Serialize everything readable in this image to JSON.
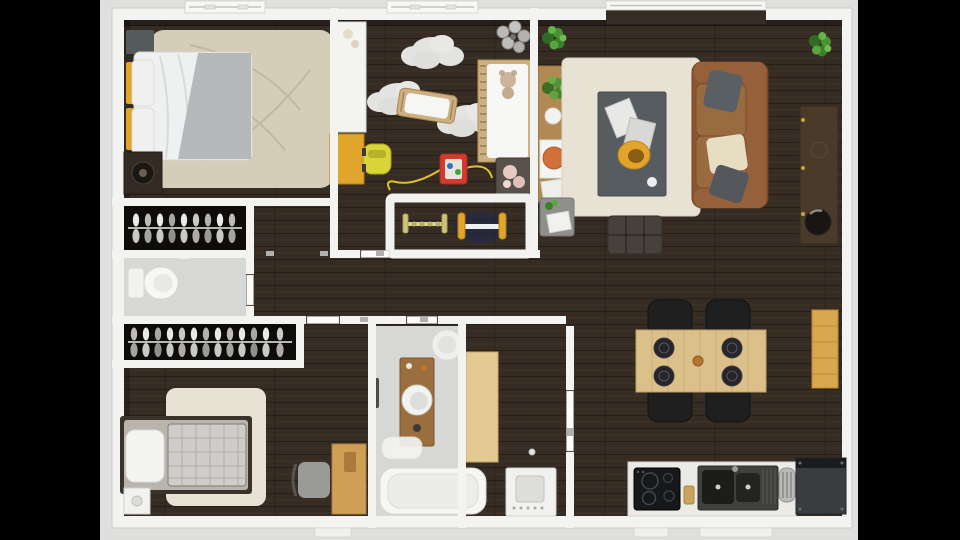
{
  "scene": {
    "title": "3D rendered top-down apartment floor plan, letterboxed on black",
    "type": "floor-plan-render"
  },
  "colors": {
    "letterbox": "#000000",
    "backdrop": "#dfdfdd",
    "wall": "#f3f3f1",
    "wall_edge": "#c9c9c7",
    "floor_dark": "#372c23",
    "floor_light": "#d7d7d5",
    "closet_dark": "#0d0c0b",
    "rug_beige": "#d6cdb9",
    "rug_cream": "#e7e2d4",
    "bed_white": "#eff0f0",
    "blanket_gray": "#b6b9bb",
    "plaid_gray": "#cfcdc9",
    "sofa_brown": "#8a5732",
    "sofa_cushion": "#9a6a40",
    "coffee_table_gray": "#575c60",
    "ottoman_dark": "#46413b",
    "wood_light": "#e5c992",
    "wood_medium": "#b08a52",
    "wood_dark": "#4a3a29",
    "dining_wood": "#dcc08a",
    "desk_wood": "#cf9f55",
    "crib_wood": "#cbb083",
    "vanity_wood": "#9a6f3d",
    "bench_wood": "#d9a84e",
    "accent_yellow": "#e0a52a",
    "toycar_yellow": "#d9d438",
    "plant_green": "#4a9334",
    "orange_plate": "#d2703b",
    "appliance_dark": "#3a3d3f",
    "cooktop_black": "#17181a",
    "sink_dark": "#3f413d",
    "chair_black": "#1f1f1f",
    "washer_white": "#f1f1ef"
  },
  "rooms": [
    {
      "name": "bedroom-1",
      "furniture": [
        "double-bed",
        "yellow-pillows",
        "gray-throw",
        "beige-rug",
        "nightstand",
        "speaker-cabinet",
        "window"
      ]
    },
    {
      "name": "closet-1",
      "furniture": [
        "clothes-rail-with-hangers"
      ]
    },
    {
      "name": "wc",
      "furniture": [
        "toilet"
      ]
    },
    {
      "name": "closet-2",
      "furniture": [
        "clothes-rail-with-hangers"
      ]
    },
    {
      "name": "bedroom-2",
      "furniture": [
        "single-bed",
        "plaid-blanket",
        "cream-rug",
        "white-nightstand",
        "wood-desk",
        "desk-chair"
      ]
    },
    {
      "name": "nursery",
      "furniture": [
        "white-wardrobe",
        "yellow-dresser",
        "toy-car",
        "cloud-rugs",
        "cradle",
        "crib-with-teddy",
        "pendant-lamp",
        "toy-blocks-with-string",
        "storage-basket-with-plush",
        "baby-gym-pen",
        "window"
      ]
    },
    {
      "name": "bathroom",
      "furniture": [
        "round-ceiling-lamp",
        "wood-vanity",
        "round-sink",
        "dark-towel",
        "bath-mat",
        "bathtub"
      ]
    },
    {
      "name": "laundry-hall",
      "furniture": [
        "wood-counter",
        "washing-machine",
        "door"
      ]
    },
    {
      "name": "living-room",
      "furniture": [
        "potted-plant-left",
        "potted-plant-right",
        "console-table-with-vase-and-plate",
        "cream-rug",
        "coffee-table-with-magazines-and-bowl",
        "leather-sofa-with-pillows",
        "tufted-ottoman",
        "media-console-with-bowl",
        "side-stool-with-papers",
        "window-bay"
      ]
    },
    {
      "name": "dining-area",
      "furniture": [
        "wood-dining-table",
        "four-black-chairs",
        "four-place-settings",
        "pepper-mill",
        "wall-bench"
      ]
    },
    {
      "name": "kitchen",
      "furniture": [
        "white-counter",
        "black-cooktop",
        "cutting-board",
        "double-sink",
        "dish-rack",
        "dark-appliance"
      ]
    }
  ]
}
